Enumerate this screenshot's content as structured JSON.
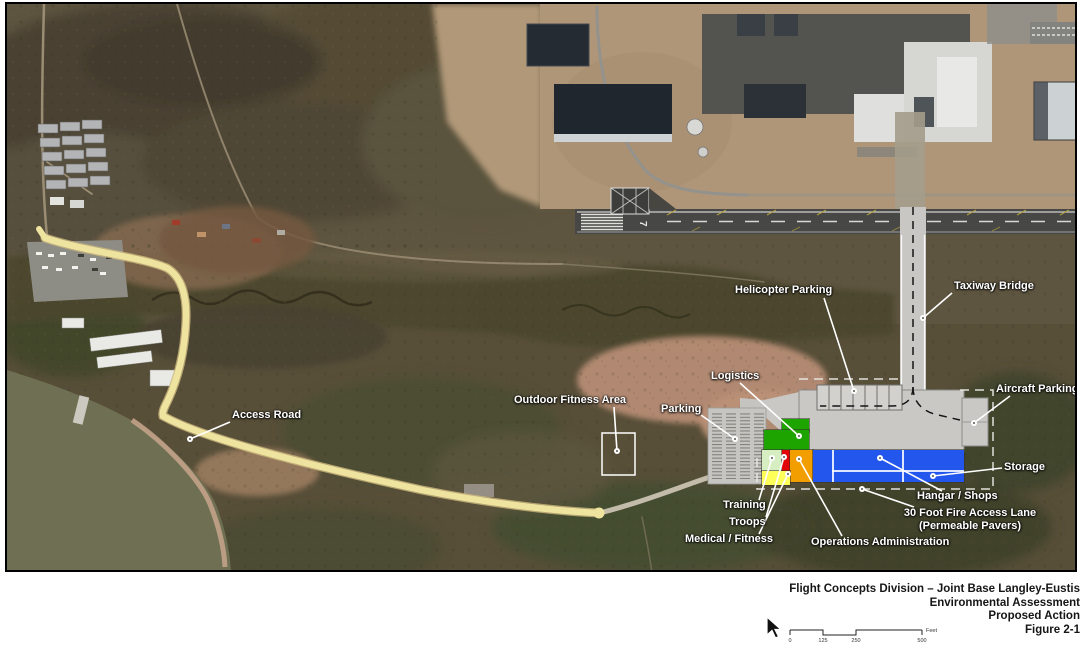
{
  "map": {
    "labels": {
      "helicopter_parking": "Helicopter Parking",
      "taxiway_bridge": "Taxiway Bridge",
      "logistics": "Logistics",
      "parking": "Parking",
      "outdoor_fitness_area": "Outdoor Fitness Area",
      "aircraft_parking": "Aircraft Parking",
      "storage": "Storage",
      "hangar_shops": "Hangar / Shops",
      "fire_access_lane_line1": "30 Foot Fire Access Lane",
      "fire_access_lane_line2": "(Permeable Pavers)",
      "training": "Training",
      "troops": "Troops",
      "medical_fitness": "Medical / Fitness",
      "operations_administration": "Operations Administration",
      "access_road": "Access Road"
    },
    "runway_number": "7",
    "building_colors": {
      "logistics": "#1ea400",
      "training": "#d7eec3",
      "troops": "#e30505",
      "medical_fitness": "#ffff5a",
      "operations_administration": "#f29d00",
      "hangar_storage": "#2356ed"
    },
    "access_road_color": "#efe3a0"
  },
  "title_block": {
    "lines": [
      "Flight Concepts Division –  Joint Base Langley-Eustis",
      "Environmental Assessment",
      "Proposed Action",
      "Figure 2-1"
    ]
  },
  "scale_bar": {
    "ticks": [
      "0",
      "125",
      "250",
      "500"
    ],
    "unit": "Feet"
  },
  "icons": {
    "cursor": "mouse-pointer-arrow"
  }
}
